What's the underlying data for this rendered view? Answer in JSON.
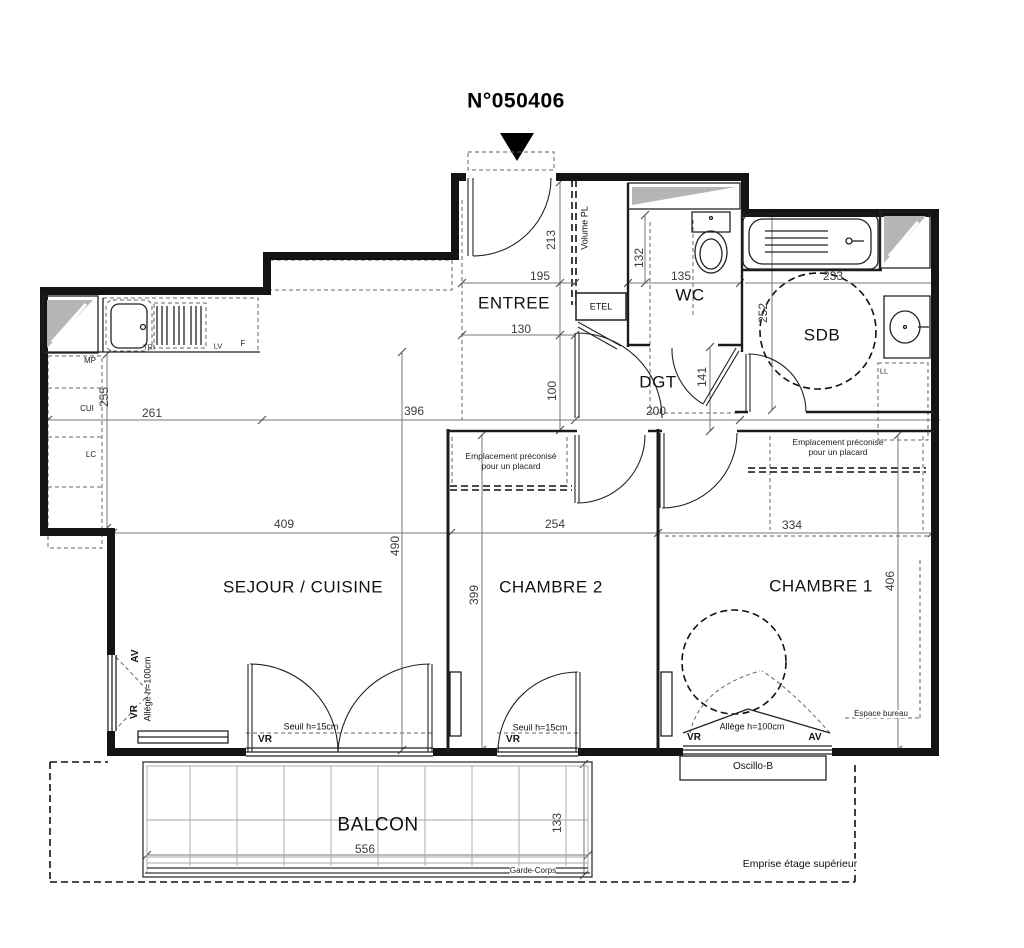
{
  "title": "N°050406",
  "rooms": {
    "entree": "ENTREE",
    "wc": "WC",
    "sdb": "SDB",
    "dgt": "DGT",
    "sejour": "SEJOUR / CUISINE",
    "chambre2": "CHAMBRE 2",
    "chambre1": "CHAMBRE 1",
    "balcon": "BALCON"
  },
  "dims": {
    "entree_h": "213",
    "entree_w": "195",
    "entree_d": "130",
    "wc_h": "132",
    "wc_w": "135",
    "sdb_w": "233",
    "sdb_h": "252",
    "cuisine_h": "255",
    "cuisine_w": "261",
    "sejour_top": "396",
    "dgt_off": "100",
    "dgt_w": "200",
    "dgt_h": "141",
    "sejour_w": "409",
    "sejour_h": "490",
    "ch2_h": "399",
    "ch2_w": "254",
    "ch1_w": "334",
    "ch1_h": "406",
    "balcon_w": "556",
    "balcon_d": "133"
  },
  "labels": {
    "volume_pl": "Volume PL",
    "etel": "ETEL",
    "mp": "MP",
    "cui": "CUI",
    "lc": "LC",
    "tri": "TRI",
    "lv": "LV",
    "f": "F",
    "ll": "LL",
    "vr": "VR",
    "av": "AV",
    "seuil": "Seuil  h=15cm",
    "allege": "Allège h=100cm",
    "oscillo": "Oscillo-B",
    "espace_bureau": "Espace bureau",
    "garde_corps": "Garde-Corps",
    "emprise": "Emprise étage supérieur",
    "placard": "Emplacement préconisé pour un placard"
  },
  "colors": {
    "wall": "#141414",
    "dim": "#3c3c3c",
    "shaft": "#b5b5b5",
    "grid": "#a6a6a6"
  }
}
